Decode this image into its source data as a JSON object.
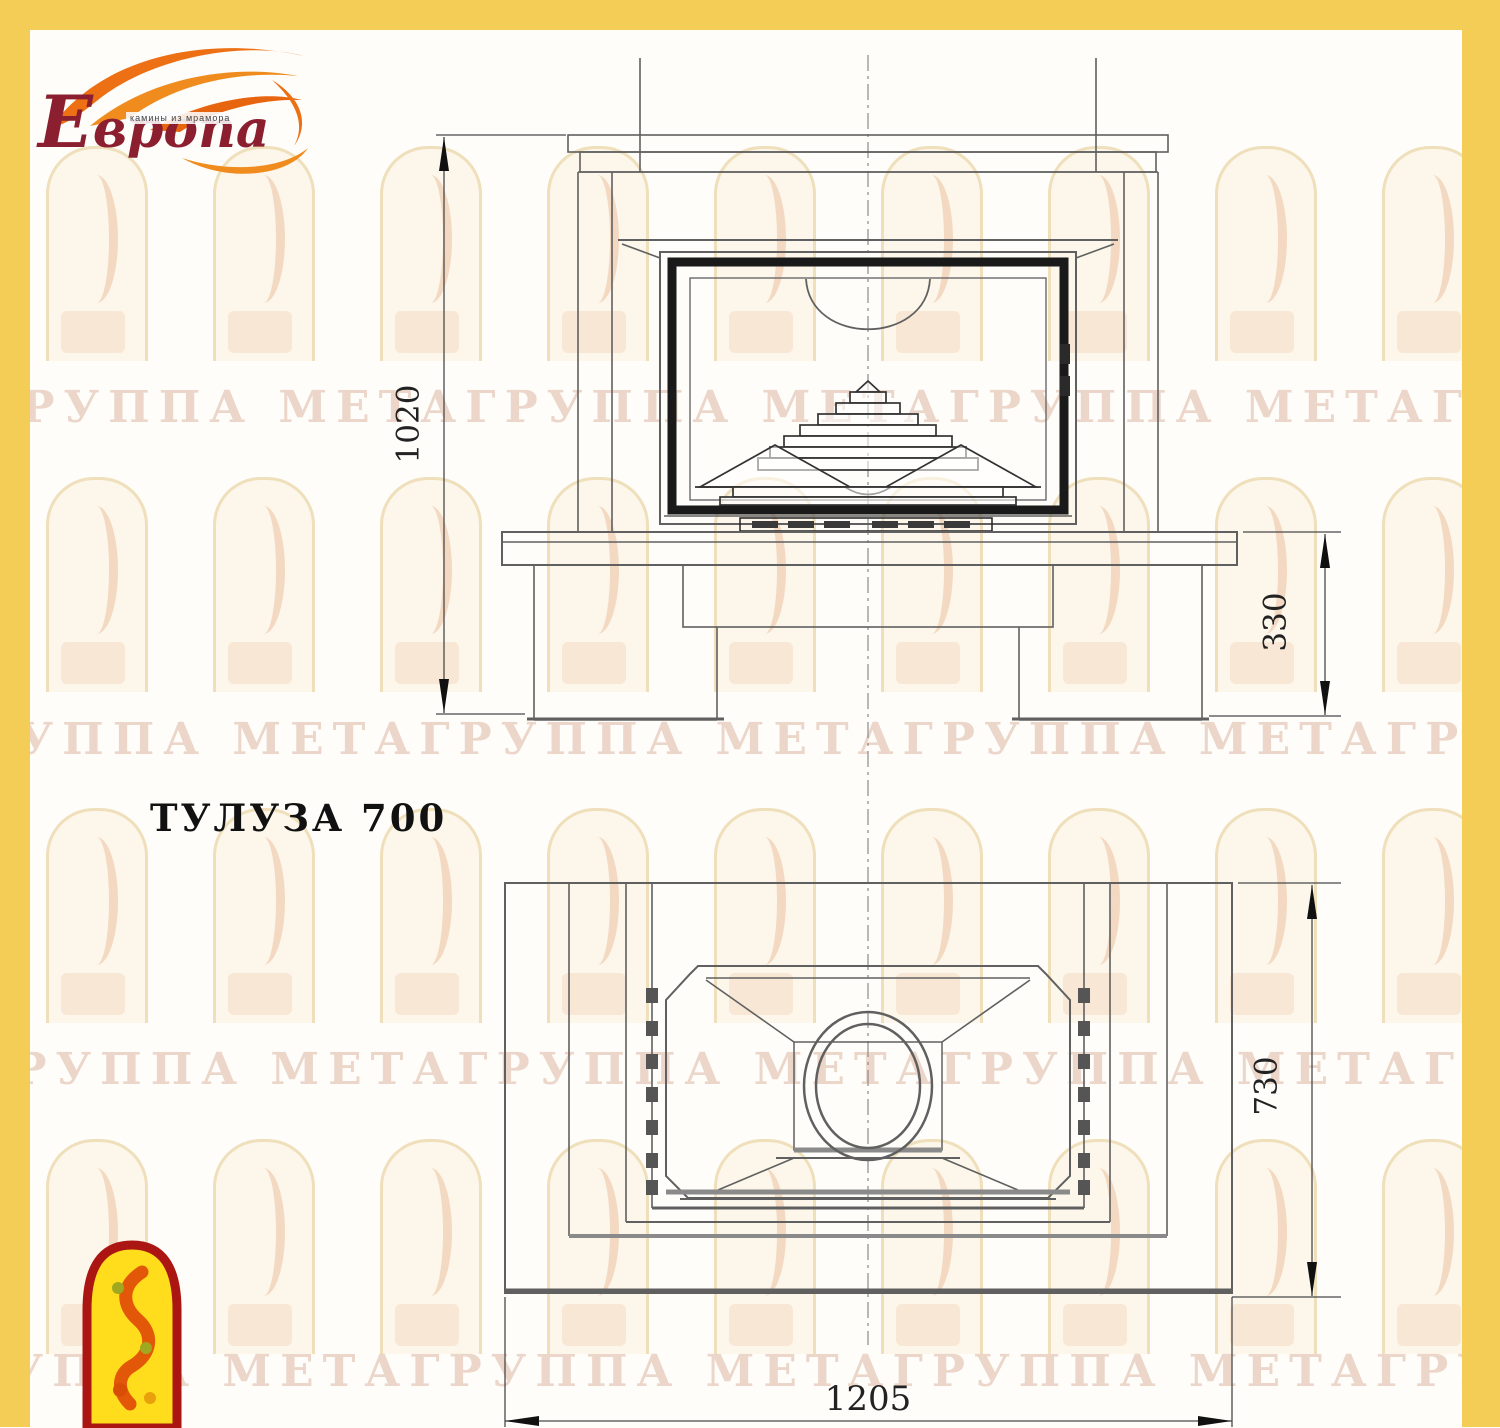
{
  "logo": {
    "name": "Европа",
    "tagline": "камины из мрамора",
    "flame_icon": "flame-swoosh-icon",
    "colors": {
      "text_red": "#8B1F2F",
      "flame_orange": "#ED7014"
    }
  },
  "title": "ТУЛУЗА 700",
  "watermark": {
    "row_text": "ГРУППА МЕТАГРУППА МЕТАГРУППА МЕТАГРУППА МЕТА",
    "motif": "arched-window-firebird"
  },
  "drawing": {
    "front_view": {
      "dimensions": {
        "total_height": "1020",
        "base_height": "330"
      }
    },
    "plan_view": {
      "dimensions": {
        "depth": "730",
        "total_width": "1205"
      }
    }
  },
  "colors": {
    "frame_yellow": "#F3CD55",
    "line_gray": "#606060",
    "door_frame_black": "#1a1a1a",
    "watermark_tan": "#C68A66",
    "firebird_yellow": "#FFDD1C",
    "firebird_red": "#AB1512",
    "firebird_orange": "#E25708"
  }
}
